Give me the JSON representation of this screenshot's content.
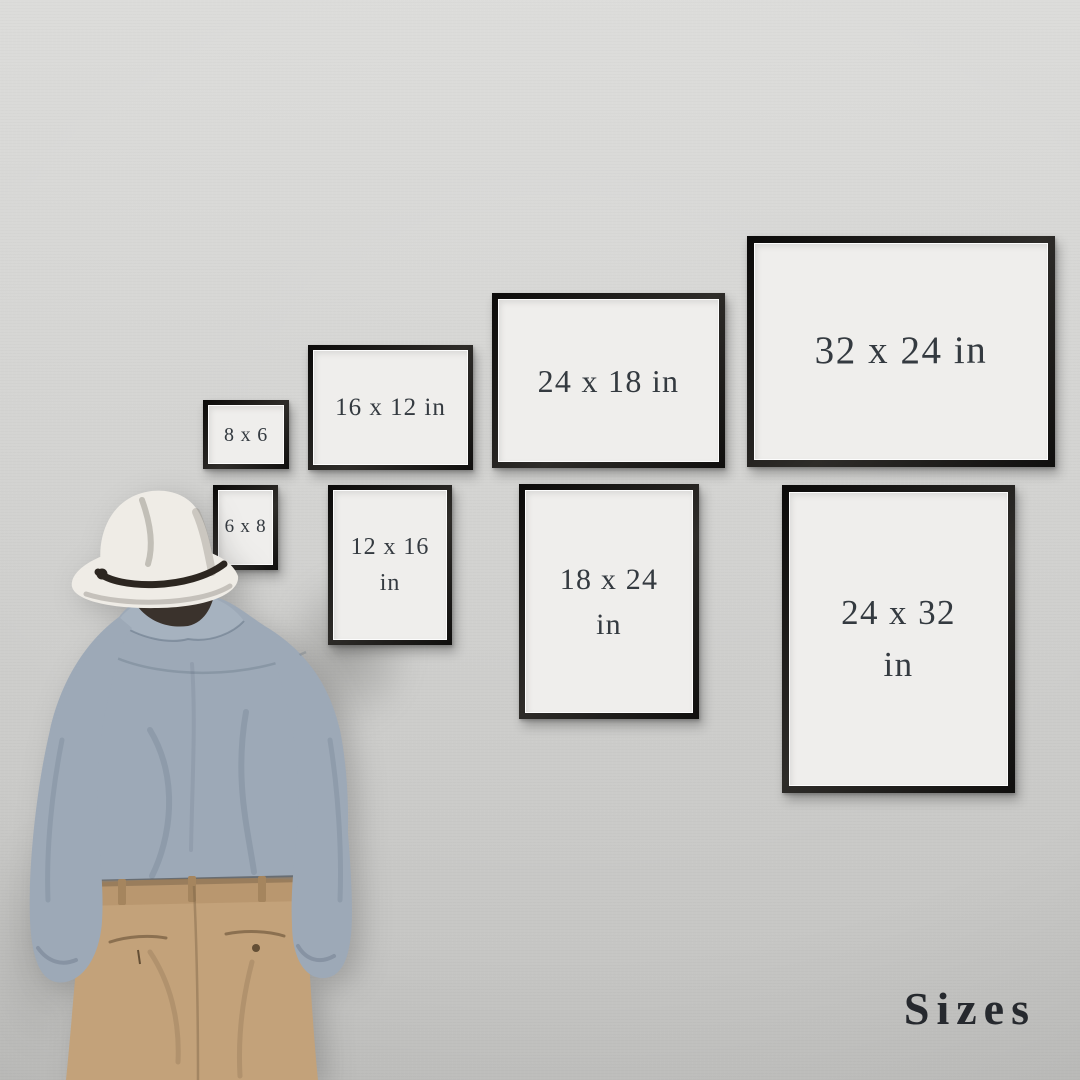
{
  "watermark": {
    "label": "Sizes"
  },
  "frames": {
    "top_row": [
      {
        "label": "8 x 6"
      },
      {
        "label": "16 x 12 in"
      },
      {
        "label": "24 x 18 in"
      },
      {
        "label": "32 x 24 in"
      }
    ],
    "bottom_row": [
      {
        "label": "6 x 8"
      },
      {
        "label": "12 x 16 in"
      },
      {
        "label": "18 x 24 in"
      },
      {
        "label": "24 x 32 in"
      }
    ]
  },
  "colors": {
    "wall_top": "#dcdcda",
    "wall_mid": "#d2d2d0",
    "wall_bottom": "#c3c3c1",
    "mat": "#efeeec",
    "label_text": "#343a40",
    "title_text": "#26292e",
    "hat": "#efece6",
    "hat_band": "#2c2620",
    "hair": "#3a322c",
    "shirt": "#9da9b7",
    "pants": "#c3a27a",
    "pants_band": "#b08e66"
  }
}
